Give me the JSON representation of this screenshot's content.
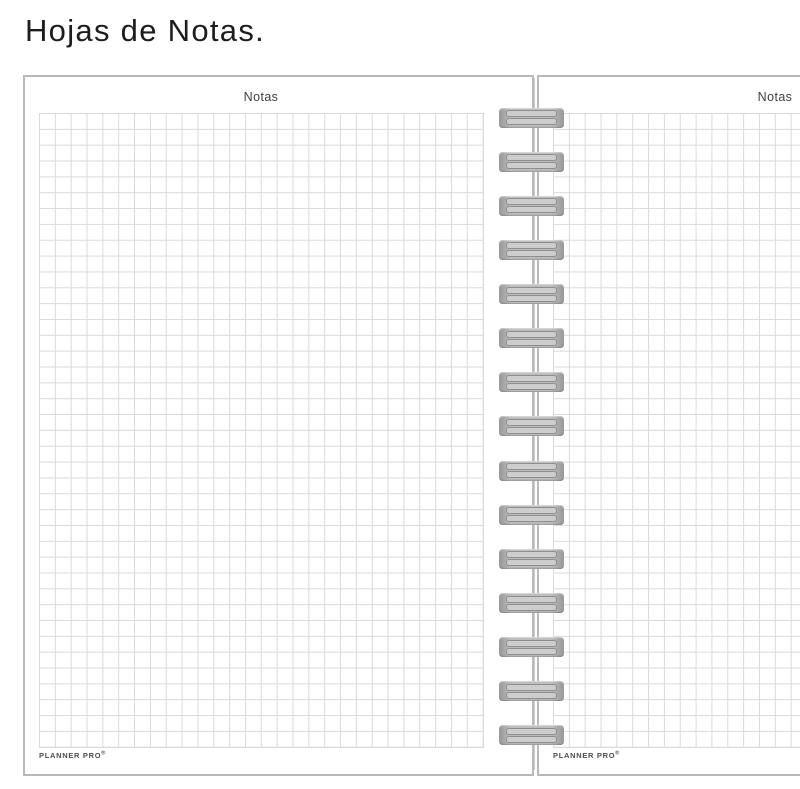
{
  "heading": {
    "title": "Hojas de Notas."
  },
  "sheets": {
    "left": {
      "header": "Notas",
      "brand": "PLANNER PRO",
      "brand_mark": "®"
    },
    "right": {
      "header": "Notas",
      "brand": "PLANNER PRO",
      "brand_mark": "®"
    }
  },
  "binding": {
    "clip_count": 15
  },
  "colors": {
    "background": "#ffffff",
    "page_fill": "#ffffff",
    "page_border": "#b9b9b9",
    "grid_line": "#dadada",
    "sheet_edge": "#cccccc",
    "binding_end": "#979797",
    "binding_mid": "#bcbcbc",
    "binding_slot_fill": "#cdcdcd",
    "binding_slot_border": "#8e8e8e",
    "heading_text": "#1d1d1d",
    "header_text": "#3f3f3f",
    "brand_text": "#4d4d4d"
  }
}
